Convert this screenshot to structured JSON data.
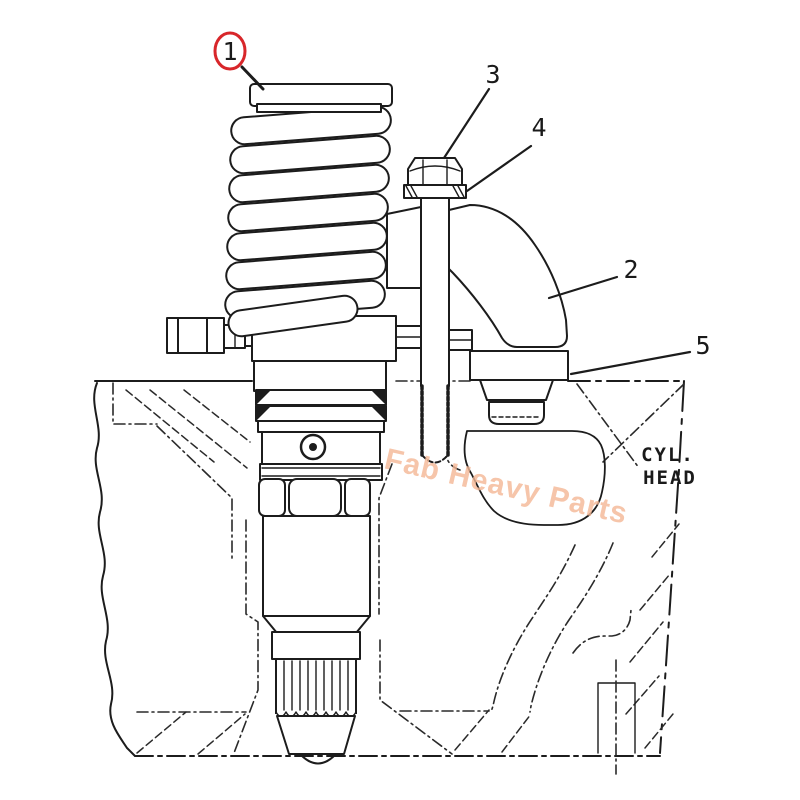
{
  "figure": {
    "callouts": [
      {
        "label": "1",
        "circled": true
      },
      {
        "label": "2",
        "circled": false
      },
      {
        "label": "3",
        "circled": false
      },
      {
        "label": "4",
        "circled": false
      },
      {
        "label": "5",
        "circled": false
      }
    ],
    "annotations": {
      "cyl_head": [
        "CYL.",
        "HEAD"
      ]
    },
    "watermark": {
      "text": "Fab Heavy Parts",
      "color": "#f4b795"
    },
    "colors": {
      "ink": "#1c1c1c",
      "callout_red": "#d8262a",
      "paper": "#ffffff"
    }
  }
}
